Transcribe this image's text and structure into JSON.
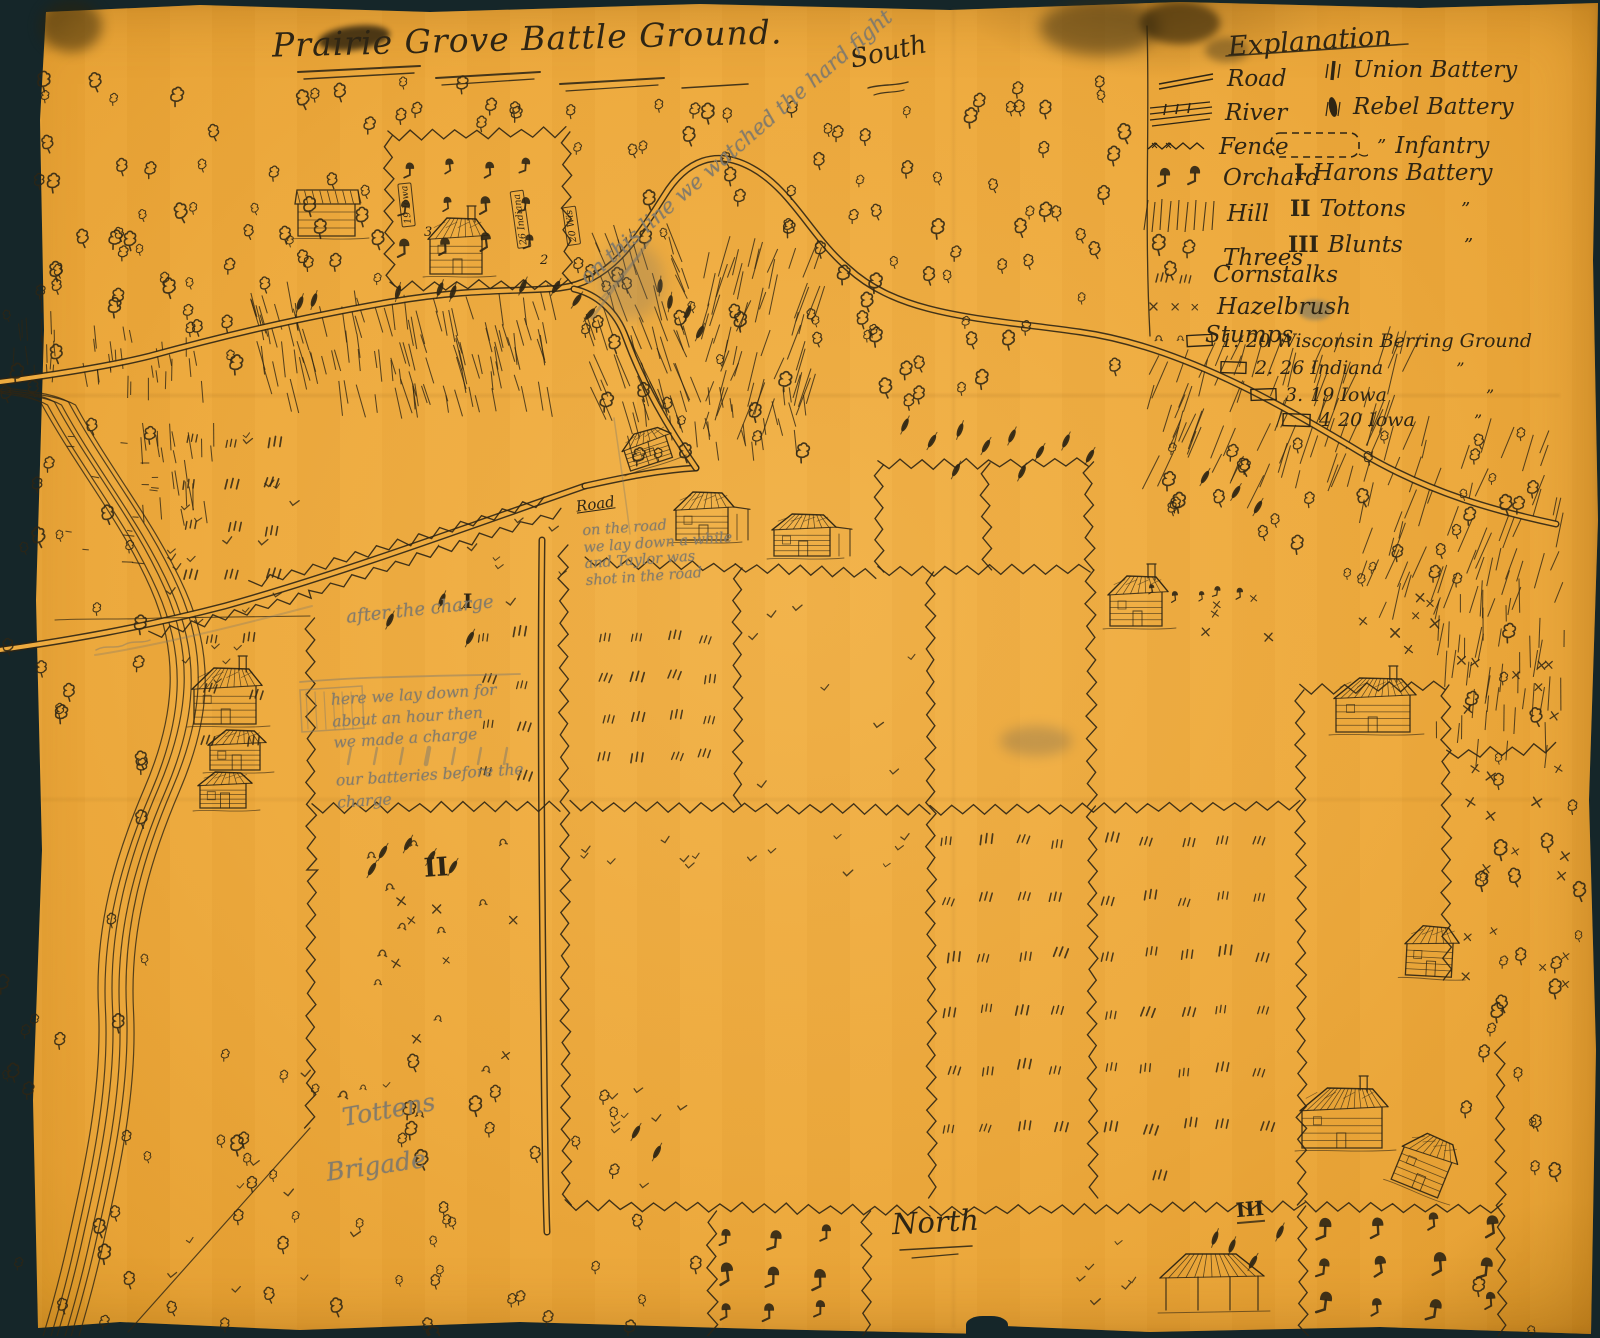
{
  "backdrop_color": "#152629",
  "paper_color": "#eda93c",
  "ink_color": "#2e2514",
  "pencil_color": "#857c6a",
  "map": {
    "title": "Prairie Grove Battle Ground.",
    "compass": {
      "south": "South",
      "north": "North"
    },
    "legend": {
      "title": "Explanation",
      "left": [
        {
          "label": "Road"
        },
        {
          "label": "River"
        },
        {
          "label": "Fence"
        },
        {
          "label": "Orchard"
        },
        {
          "label": "Hill"
        },
        {
          "label": "Threes"
        },
        {
          "label": "Cornstalks"
        },
        {
          "label": "Hazelbrush"
        },
        {
          "label": "Stumps"
        }
      ],
      "right": [
        {
          "numeral": "",
          "label": "Union Battery",
          "ditto": ""
        },
        {
          "numeral": "",
          "label": "Rebel Battery",
          "ditto": ""
        },
        {
          "numeral": "",
          "label": "Infantry",
          "ditto": "”"
        },
        {
          "numeral": "I",
          "label": "Harons Battery",
          "ditto": ""
        },
        {
          "numeral": "II",
          "label": "Tottons",
          "ditto": "”"
        },
        {
          "numeral": "III",
          "label": "Blunts",
          "ditto": "”"
        }
      ],
      "burials": [
        {
          "num": "1.",
          "label": "20 Wisconsin Berring Ground",
          "ditto": ""
        },
        {
          "num": "2.",
          "label": "26 Indiana",
          "ditto": "”"
        },
        {
          "num": "3.",
          "label": "19 Iowa",
          "ditto": "”"
        },
        {
          "num": "4",
          "label": "20 Iowa",
          "ditto": "”"
        }
      ]
    },
    "markers": {
      "numeral_i": "I",
      "numeral_ii": "II",
      "numeral_iii": "III",
      "road": "Road",
      "graves": [
        {
          "label": "19 Iowa",
          "num": "3"
        },
        {
          "label": "26 Indiana",
          "num": "2"
        },
        {
          "label": "20 Wis",
          "num": ""
        }
      ]
    },
    "annotations": {
      "ridge": "on this line we watched the hard fight",
      "road_note": [
        "on the road",
        "we lay down a while",
        "and Taylor was",
        "shot in the road"
      ],
      "after_charge": "after the charge",
      "charge_note": [
        "here we lay down for",
        "about an hour then",
        "we made a charge",
        "our batteries before the",
        "charge"
      ],
      "brigade_1": "Tottens",
      "brigade_2": "Brigade"
    }
  }
}
